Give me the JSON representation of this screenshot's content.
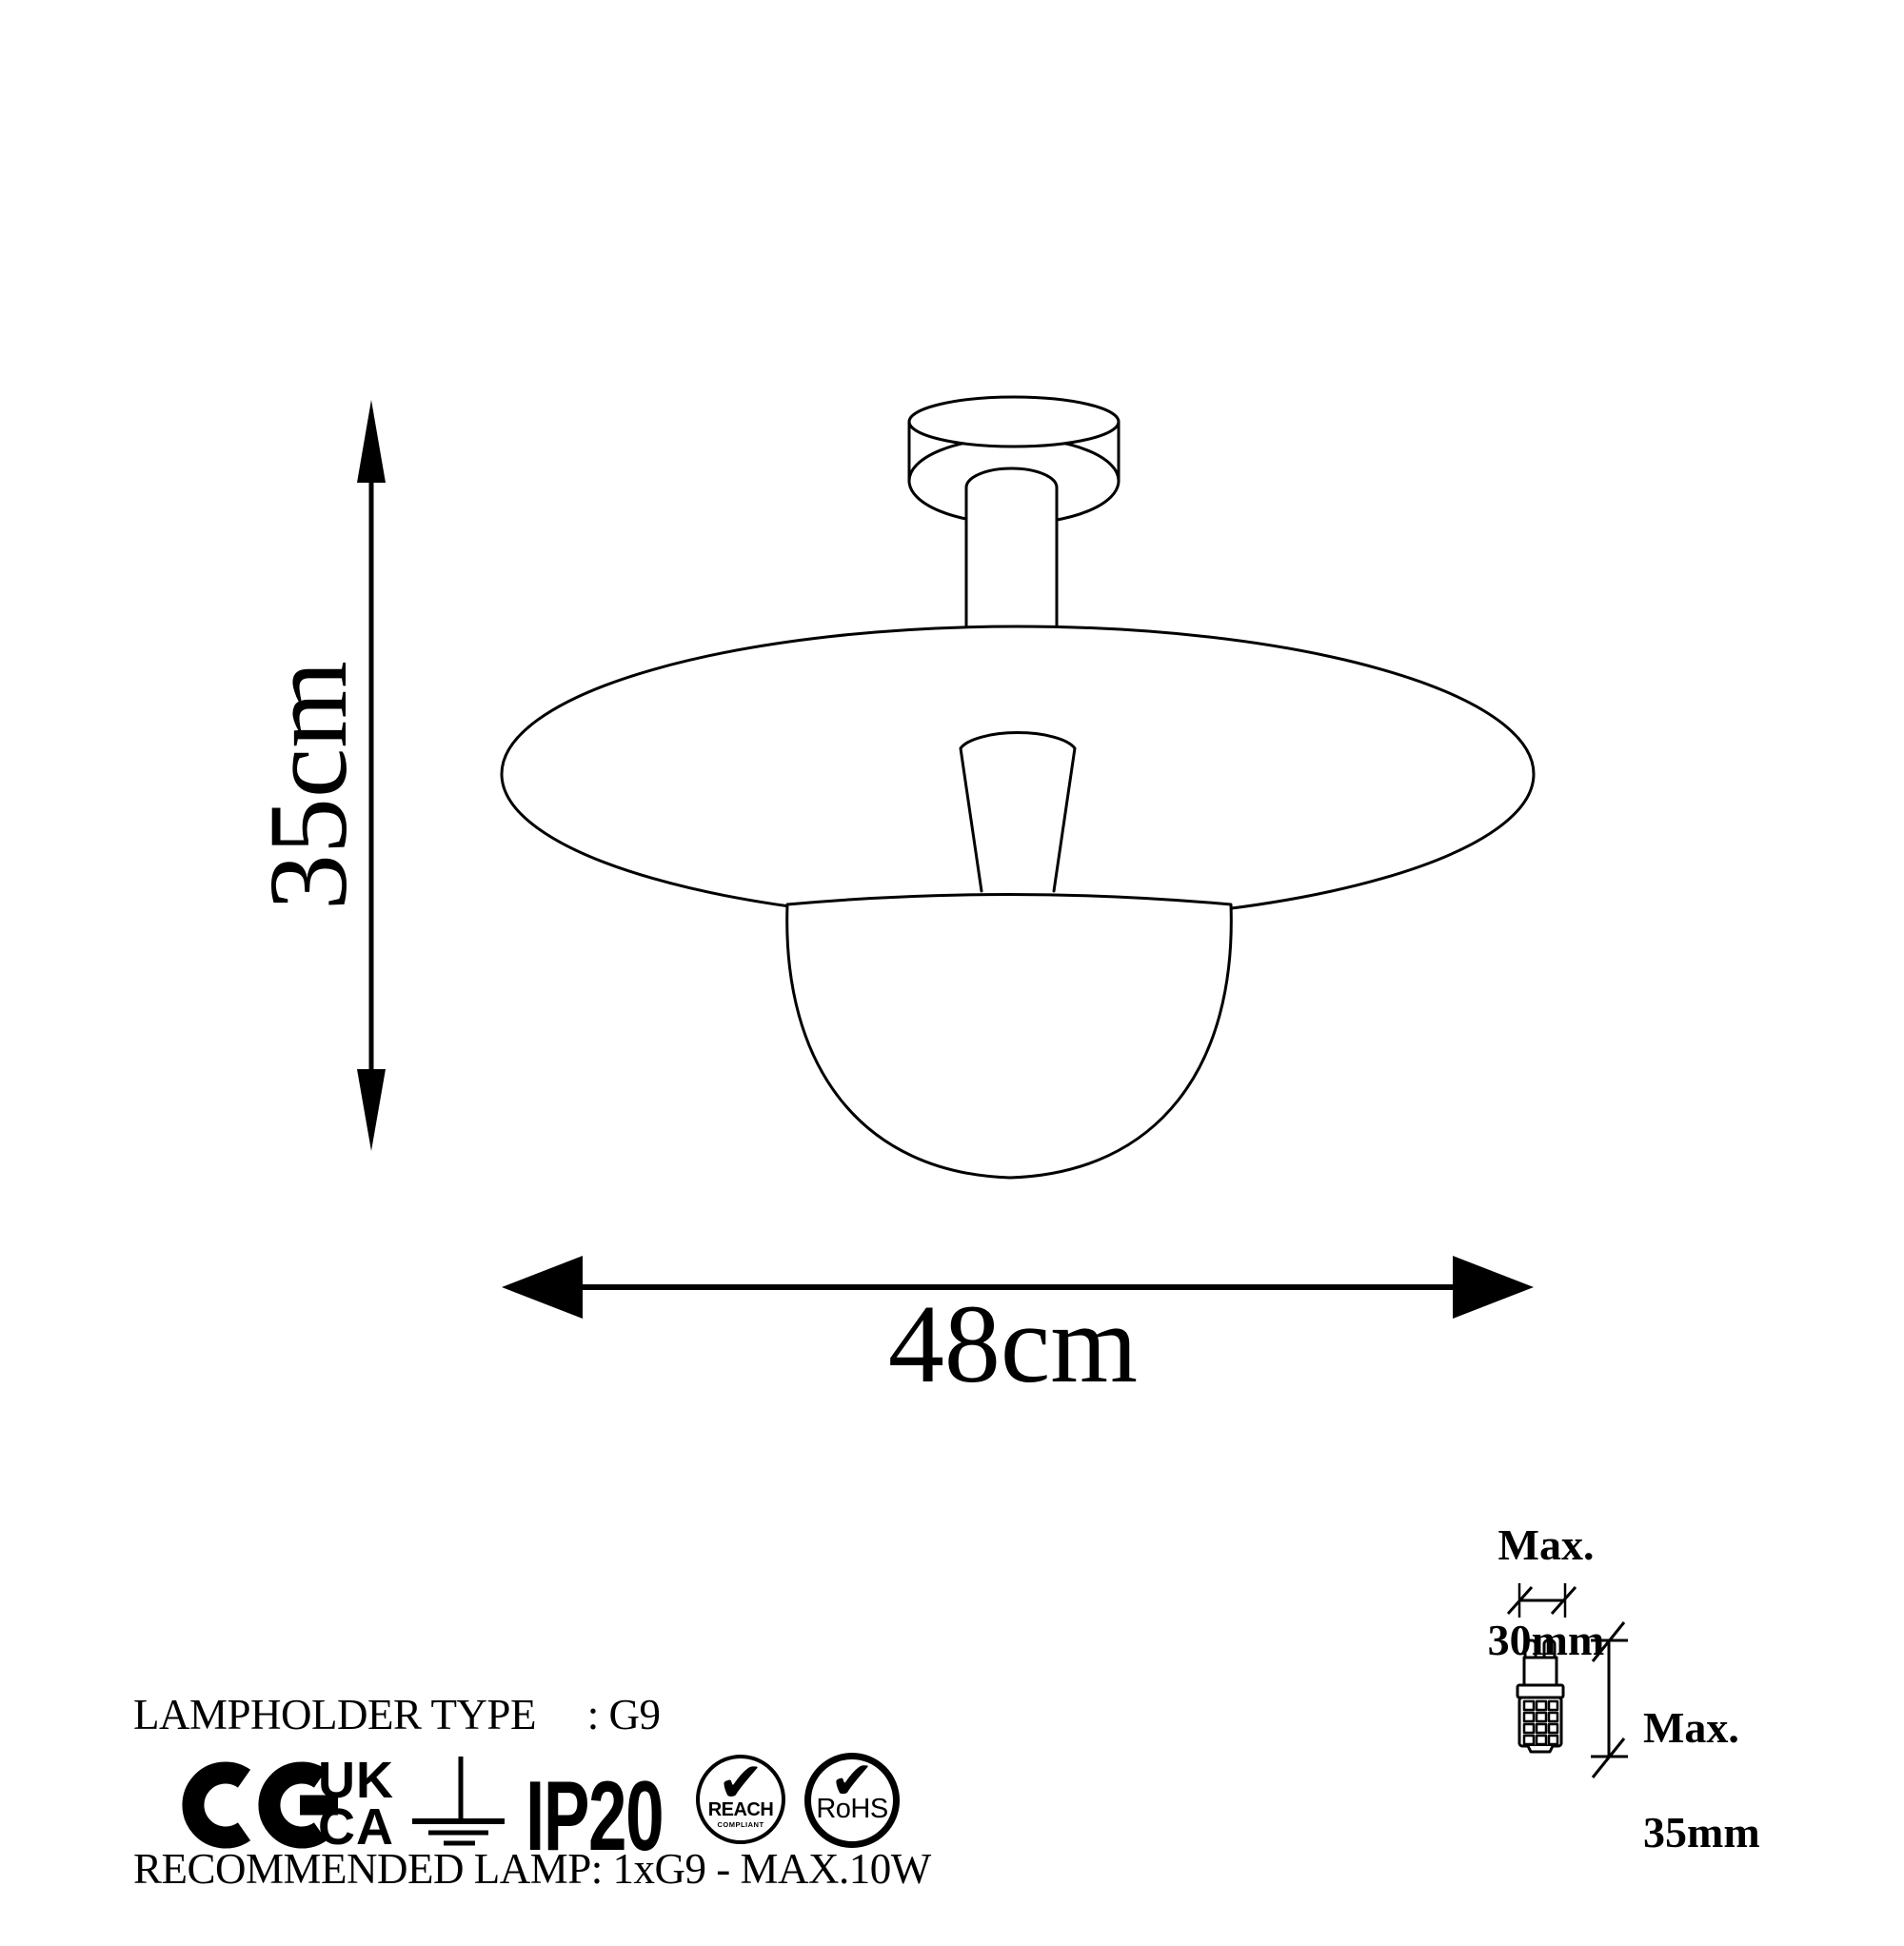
{
  "page": {
    "background": "#ffffff",
    "ink": "#000000"
  },
  "dimensions": {
    "height_label": "35cm",
    "width_label": "48cm"
  },
  "bulb_limits": {
    "width": {
      "line1": "Max.",
      "line2": "30mm"
    },
    "height": {
      "line1": "Max.",
      "line2": "35mm"
    }
  },
  "specs": {
    "line1": "LAMPHOLDER TYPE     : G9",
    "line2": "RECOMMENDED LAMP: 1xG9 - MAX.10W"
  },
  "certifications": {
    "ukca": {
      "line1": "UK",
      "line2": "CA"
    },
    "ip_rating": "IP20",
    "reach": {
      "check": "✔",
      "title": "REACH",
      "subtitle": "COMPLIANT"
    },
    "rohs": {
      "check": "✔",
      "title": "RoHS"
    }
  }
}
